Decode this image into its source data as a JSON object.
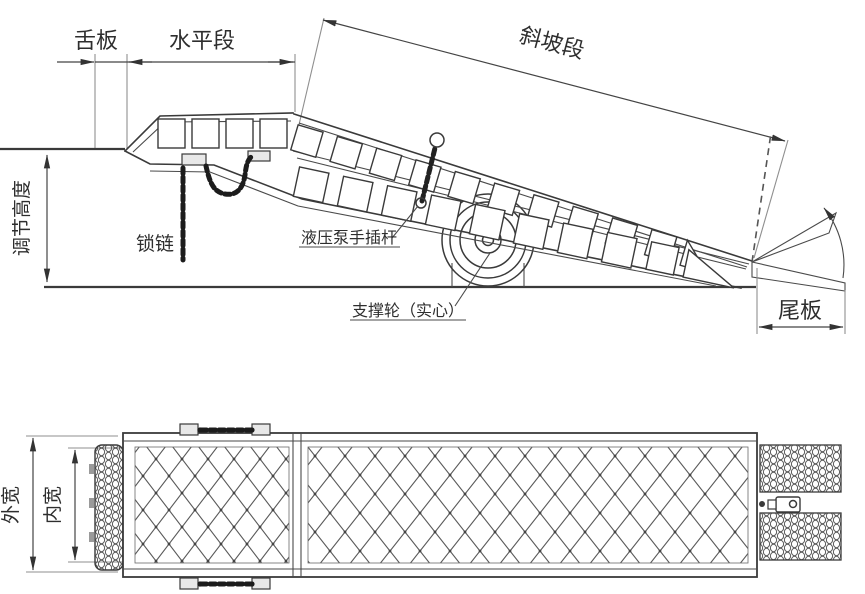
{
  "side_view": {
    "labels": {
      "tongue": "舌板",
      "horizontal_section": "水平段",
      "slope_section": "斜坡段",
      "adjustable_height": "调节高度",
      "lock_chain": "锁链",
      "hydraulic_pump_rod": "液压泵手插杆",
      "support_wheel": "支撑轮（实心）",
      "tail_plate": "尾板"
    }
  },
  "plan_view": {
    "labels": {
      "outer_width": "外宽",
      "inner_width": "内宽"
    }
  },
  "colors": {
    "line": "#3a3a3a",
    "extension_line": "#8f8f8f",
    "chain": "#1c1c1c",
    "background": "#ffffff"
  }
}
